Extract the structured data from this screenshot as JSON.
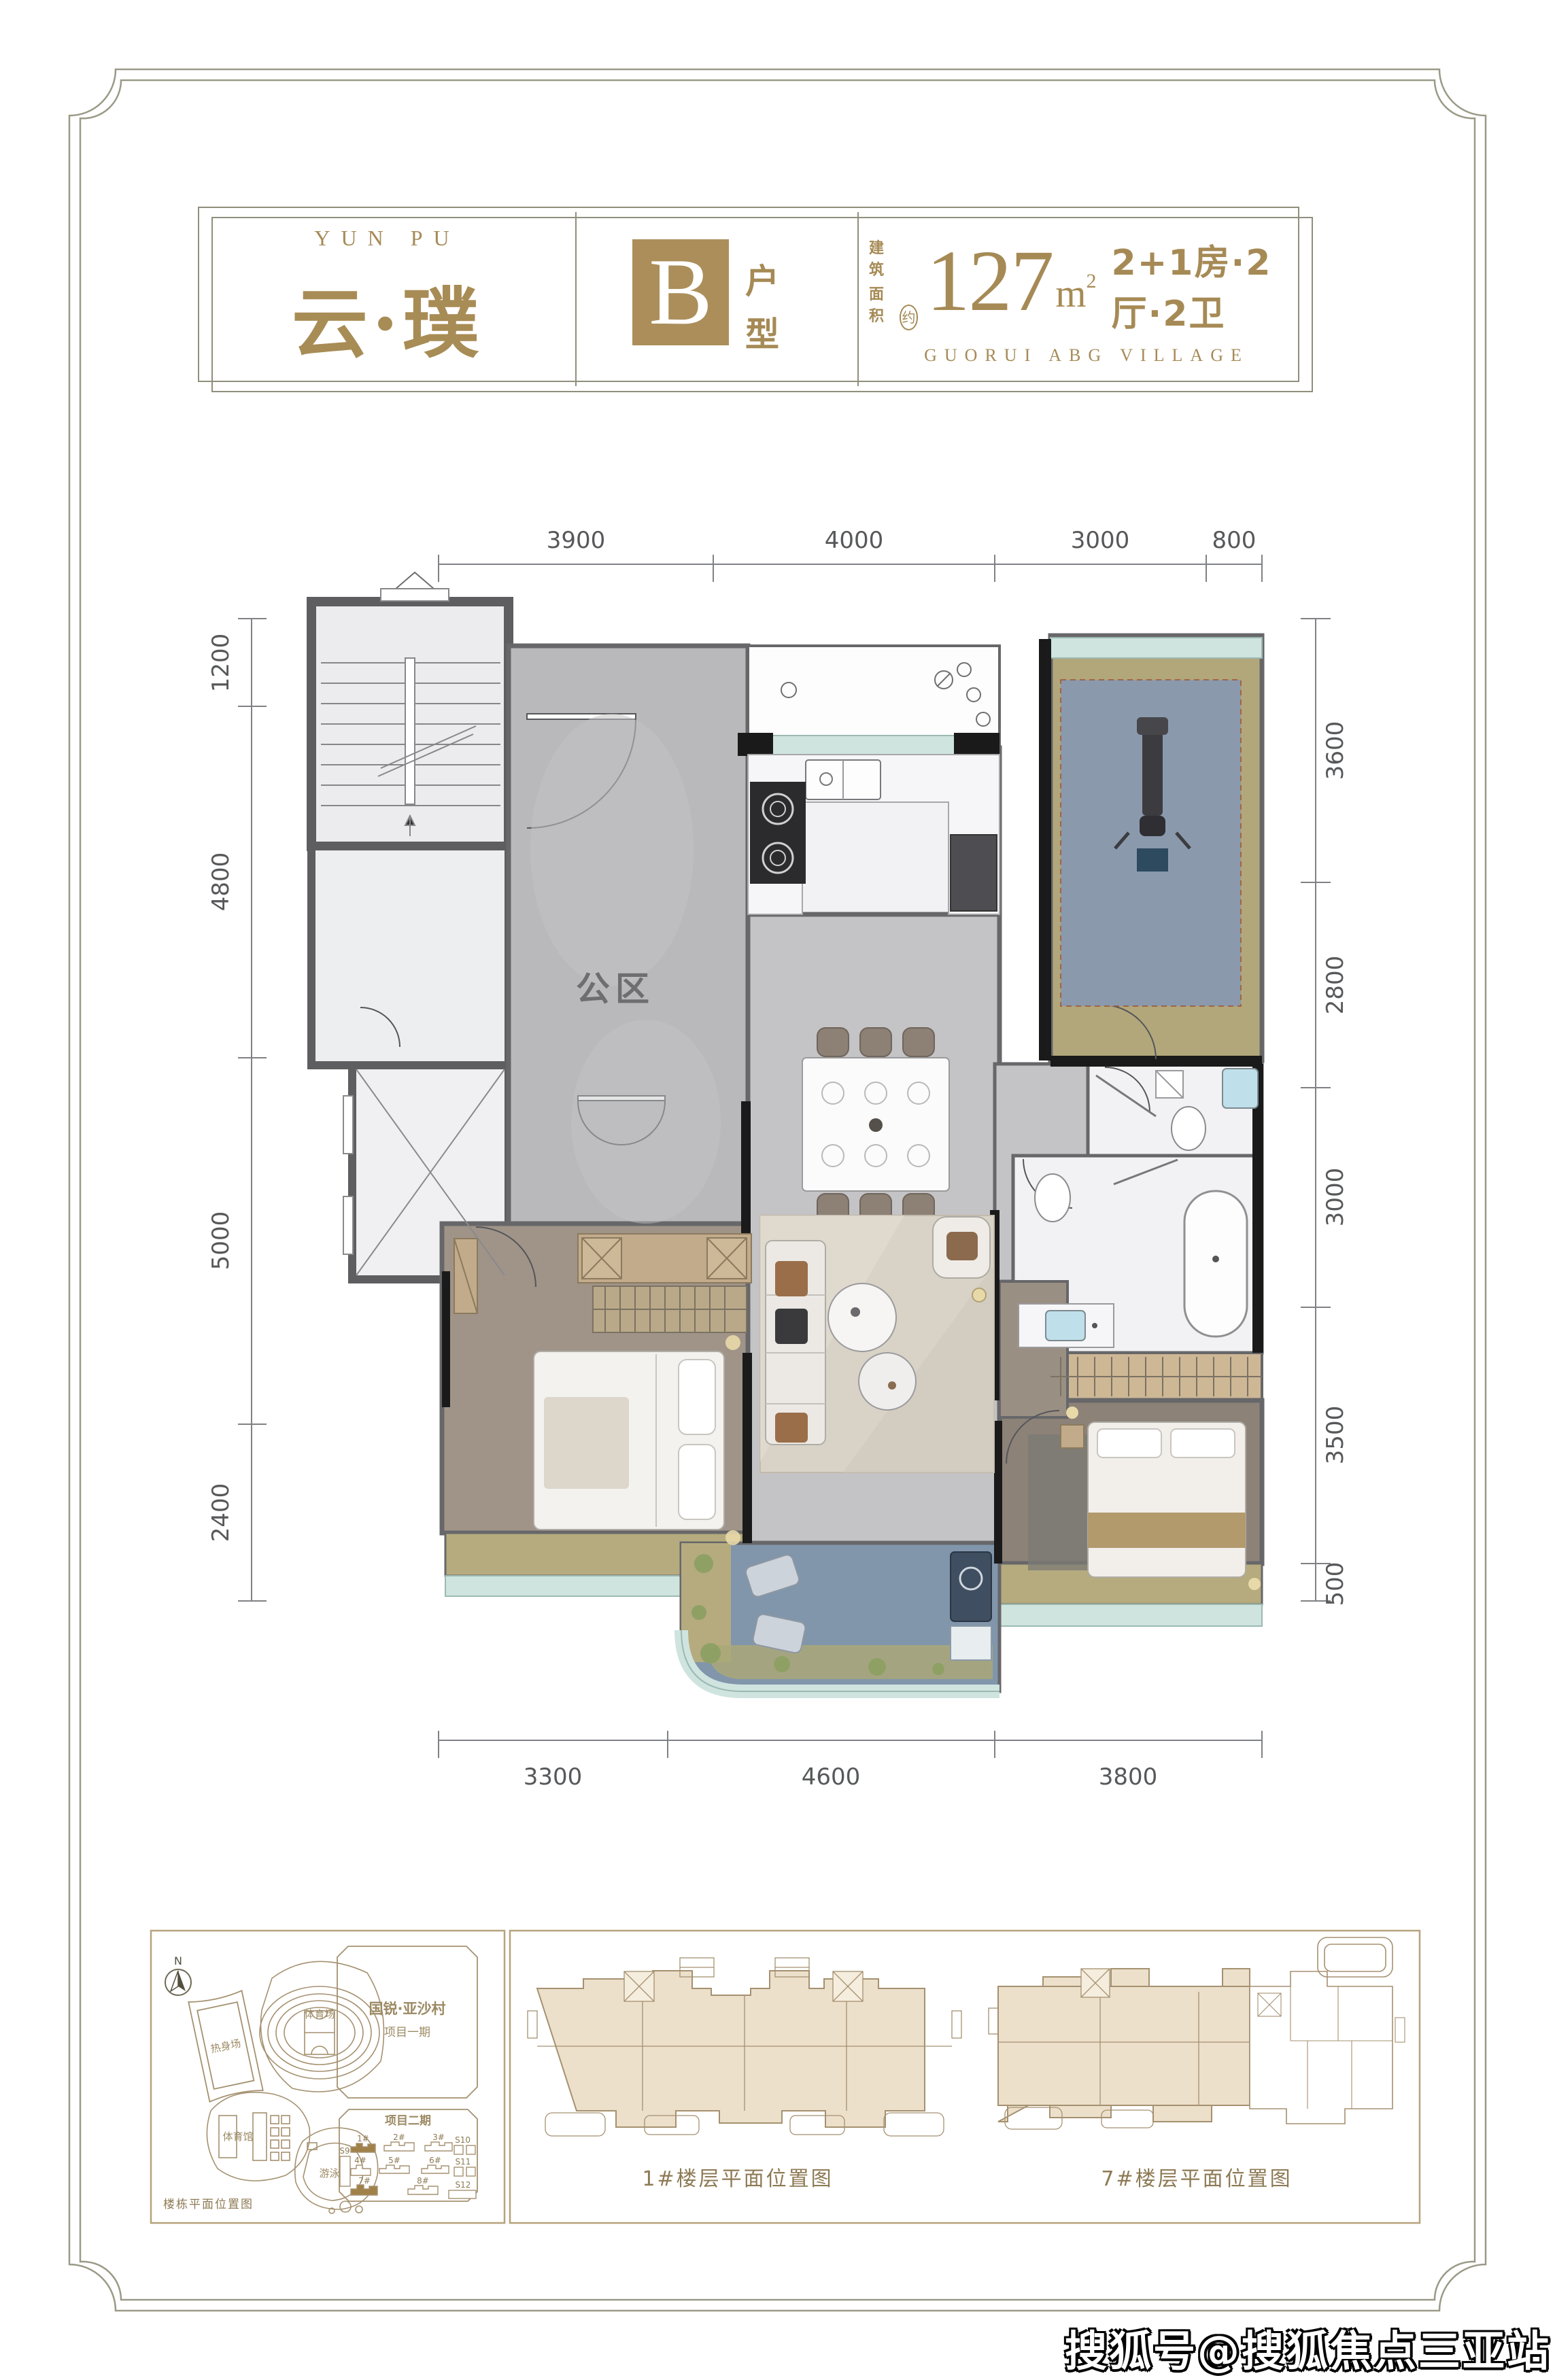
{
  "header": {
    "brand_en": "YUN PU",
    "brand_cn": "云·璞",
    "unit_letter": "B",
    "unit_type_char1": "户",
    "unit_type_char2": "型",
    "area_label_line1": "建筑",
    "area_label_line2": "面积",
    "area_approx": "约",
    "area_value": "127",
    "area_unit": "m",
    "area_sup": "2",
    "layout_text": "2+1房·2厅·2卫",
    "subtitle_en": "GUORUI ABG VILLAGE"
  },
  "plan": {
    "room_label": "公区",
    "dims_top": [
      "3900",
      "4000",
      "3000",
      "800"
    ],
    "dims_bottom": [
      "3300",
      "4600",
      "3800"
    ],
    "dims_left": [
      "1200",
      "4800",
      "5000",
      "2400"
    ],
    "dims_right": [
      "3600",
      "2800",
      "3000",
      "3500",
      "500"
    ]
  },
  "site_plan": {
    "compass": "N",
    "caption": "楼栋平面位置图",
    "warmup_field": "热身场",
    "stadium": "体育场",
    "gym": "体育馆",
    "pool": "游泳馆",
    "phase1_line1": "国锐·亚沙村",
    "phase1_line2": "项目一期",
    "phase2_title": "项目二期",
    "buildings": [
      "1#",
      "2#",
      "3#",
      "4#",
      "5#",
      "6#",
      "7#",
      "8#"
    ],
    "s_labels": [
      "S9",
      "S10",
      "S11",
      "S12"
    ]
  },
  "floor_panels": {
    "b1_caption": "1#楼层平面位置图",
    "b7_caption": "7#楼层平面位置图"
  },
  "watermark": "搜狐号@搜狐焦点三亚站",
  "colors": {
    "brand_gold": "#a68b58",
    "unit_box_gold": "#ab8e5a",
    "highlight_building_gold": "#a08148",
    "frame_line": "#9a9a87",
    "wall_gray": "#5e5e60",
    "wall_black": "#1a1a1a",
    "public_marble": "#b9b9bb",
    "unit_marble": "#c4c3c5",
    "white_marble": "#f2f1f3",
    "wood_floor": "#a09488",
    "olive_floor": "#b2a77b",
    "rug_blue": "#8b99ad",
    "balcony_blue": "#8196ab",
    "window_teal": "#cfe4df",
    "living_rug": "#d9d3c7",
    "plate_beige": "#ece0cb"
  }
}
